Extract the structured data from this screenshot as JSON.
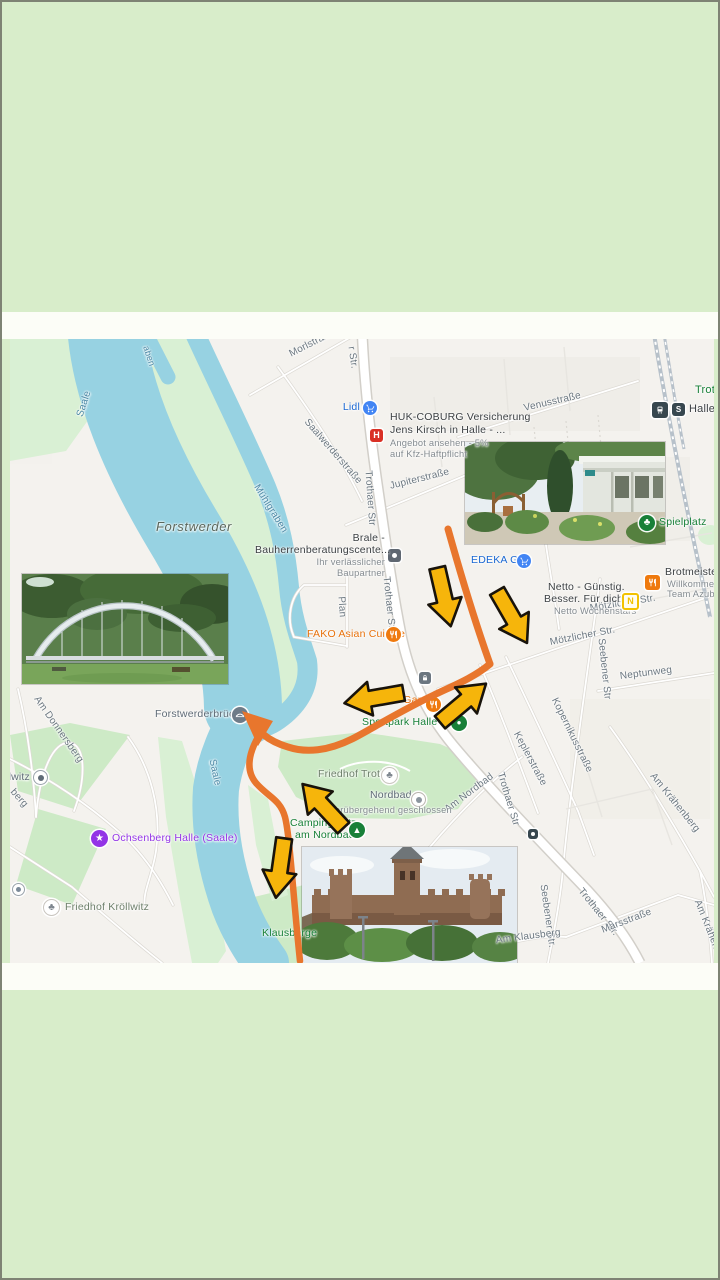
{
  "colors": {
    "background": "#d8edca",
    "band": "#fcfdf7",
    "water": "#97d2e2",
    "park": "#cdeac6",
    "island": "#d9f0d4",
    "route_orange": "#e8762d",
    "arrow_yellow": "#f6b50b",
    "poi_blue": "#1967d2",
    "poi_orange": "#e8710a",
    "poi_green": "#188038",
    "poi_purple": "#9334e6"
  },
  "map": {
    "water_labels": [
      {
        "text": "Saale"
      },
      {
        "text": "Mühlgraben"
      },
      {
        "text": "Saale"
      },
      {
        "text": "aben"
      }
    ],
    "area_labels": [
      {
        "text": "Forstwerder"
      },
      {
        "text": "Klausberge"
      },
      {
        "text": "Trotha"
      }
    ],
    "street_labels": [
      {
        "text": "Morlstraße"
      },
      {
        "text": "Saalwerderstraße"
      },
      {
        "text": "Venusstraße"
      },
      {
        "text": "Jupiterstraße"
      },
      {
        "text": "Trothaer Str"
      },
      {
        "text": "Trothaer Str."
      },
      {
        "text": "Trothaer Str."
      },
      {
        "text": "Trothaer Str"
      },
      {
        "text": "r Str."
      },
      {
        "text": "Mötzlicher Str."
      },
      {
        "text": "Mötzlicher Str."
      },
      {
        "text": "Seebener Str"
      },
      {
        "text": "Seebener Str."
      },
      {
        "text": "Neptunweg"
      },
      {
        "text": "Kopernikusstraße"
      },
      {
        "text": "Keplerstraße"
      },
      {
        "text": "Plan"
      },
      {
        "text": "Am Nordbad"
      },
      {
        "text": "Am Krähenberg"
      },
      {
        "text": "Am Krähenberg"
      },
      {
        "text": "Marsstraße"
      },
      {
        "text": "Am Klausberg"
      },
      {
        "text": "Am Donnersberg"
      },
      {
        "text": "berg"
      }
    ],
    "pois": {
      "lidl": {
        "label": "Lidl",
        "icon": "shopping-cart-icon"
      },
      "huk": {
        "line1": "HUK-COBURG Versicherung",
        "line2": "Jens Kirsch in Halle - ...",
        "line3": "Angebot ansehen - 5%",
        "line4": "auf Kfz-Haftpflicht",
        "icon": "huk-h-icon"
      },
      "edeka": {
        "label": "EDEKA Goj",
        "icon": "shopping-cart-icon"
      },
      "netto": {
        "line1": "Netto - Günstig.",
        "line2": "Besser. Für dich.",
        "line3": "Netto Wochenstars",
        "icon": "netto-logo-icon"
      },
      "brot": {
        "title": "Brotmeisterei",
        "line2": "Willkommen im",
        "line3": "Team Azubi!",
        "icon": "restaurant-icon"
      },
      "spielplatz": {
        "label": "Spielplatz",
        "icon": "tree-icon"
      },
      "fako": {
        "label": "FAKO Asian Cuisine",
        "icon": "restaurant-icon"
      },
      "sweet_garden": {
        "label": "Sweet Garden",
        "icon": "restaurant-icon"
      },
      "sportpark": {
        "label": "Sportpark Halle Nord",
        "icon": "sports-icon"
      },
      "friedhof_trotha": {
        "label": "Friedhof Trotha",
        "icon": "cemetery-icon"
      },
      "nordbad": {
        "label": "Nordbad",
        "status": "vorübergehend geschlossen",
        "icon": "pool-icon"
      },
      "camping": {
        "line1": "Campingplatz",
        "line2": "am Nordbad",
        "icon": "tent-icon"
      },
      "ochsenberg": {
        "label": "Ochsenberg Halle (Saale)",
        "icon": "venue-star-icon"
      },
      "friedhof_kroellwitz": {
        "label": "Friedhof Kröllwitz",
        "icon": "cemetery-icon"
      },
      "kroellwitz": {
        "label": "Kröllwitz",
        "icon": "place-dot-icon"
      },
      "bruecke": {
        "label": "Forstwerderbrücke",
        "icon": "bridge-icon"
      },
      "station": {
        "label": "Halle Wo",
        "icon": "tram-icon"
      },
      "brale": {
        "line1": "Brale -",
        "line2": "Bauherrenberatungscente...",
        "line3": "Ihr verlässlicher",
        "line4": "Baupartner",
        "icon": "business-dot-icon"
      }
    },
    "photos": [
      {
        "name": "garden-clubhouse-photo"
      },
      {
        "name": "arch-footbridge-photo"
      },
      {
        "name": "castle-ruin-photo"
      }
    ]
  }
}
